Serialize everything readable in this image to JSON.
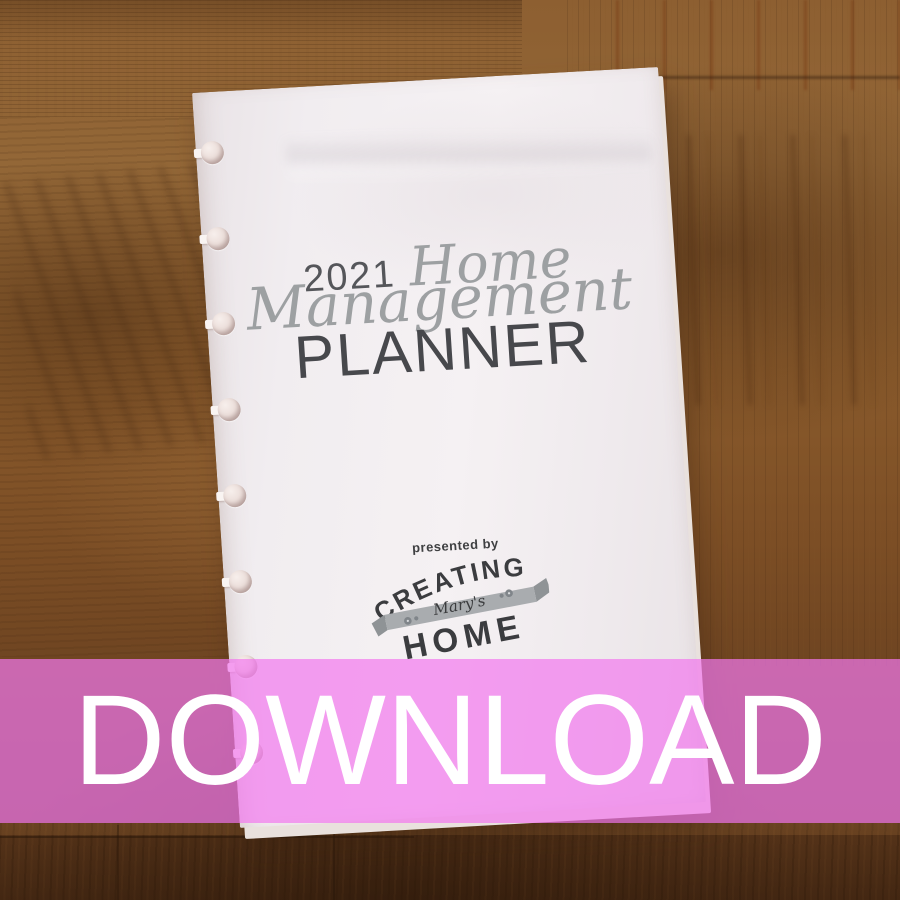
{
  "planner": {
    "year": "2021",
    "script_word1": "Home",
    "script_word2": "Management",
    "title": "PLANNER",
    "presented_by": "presented by",
    "logo": {
      "line1": "CREATING",
      "line2": "Mary's",
      "line3": "HOME"
    },
    "binding_holes": 8
  },
  "overlay": {
    "label": "DOWNLOAD",
    "banner_color": "#ee78ee",
    "text_color": "#ffffff"
  },
  "colors": {
    "paper": "#f2eef0",
    "wood_light": "#96683a",
    "wood_dark": "#5a361b",
    "title_ink": "#48494d",
    "script_gray": "#9da0a2",
    "logo_ink": "#3b3c3f",
    "ribbon_gray": "#a9acaf"
  }
}
